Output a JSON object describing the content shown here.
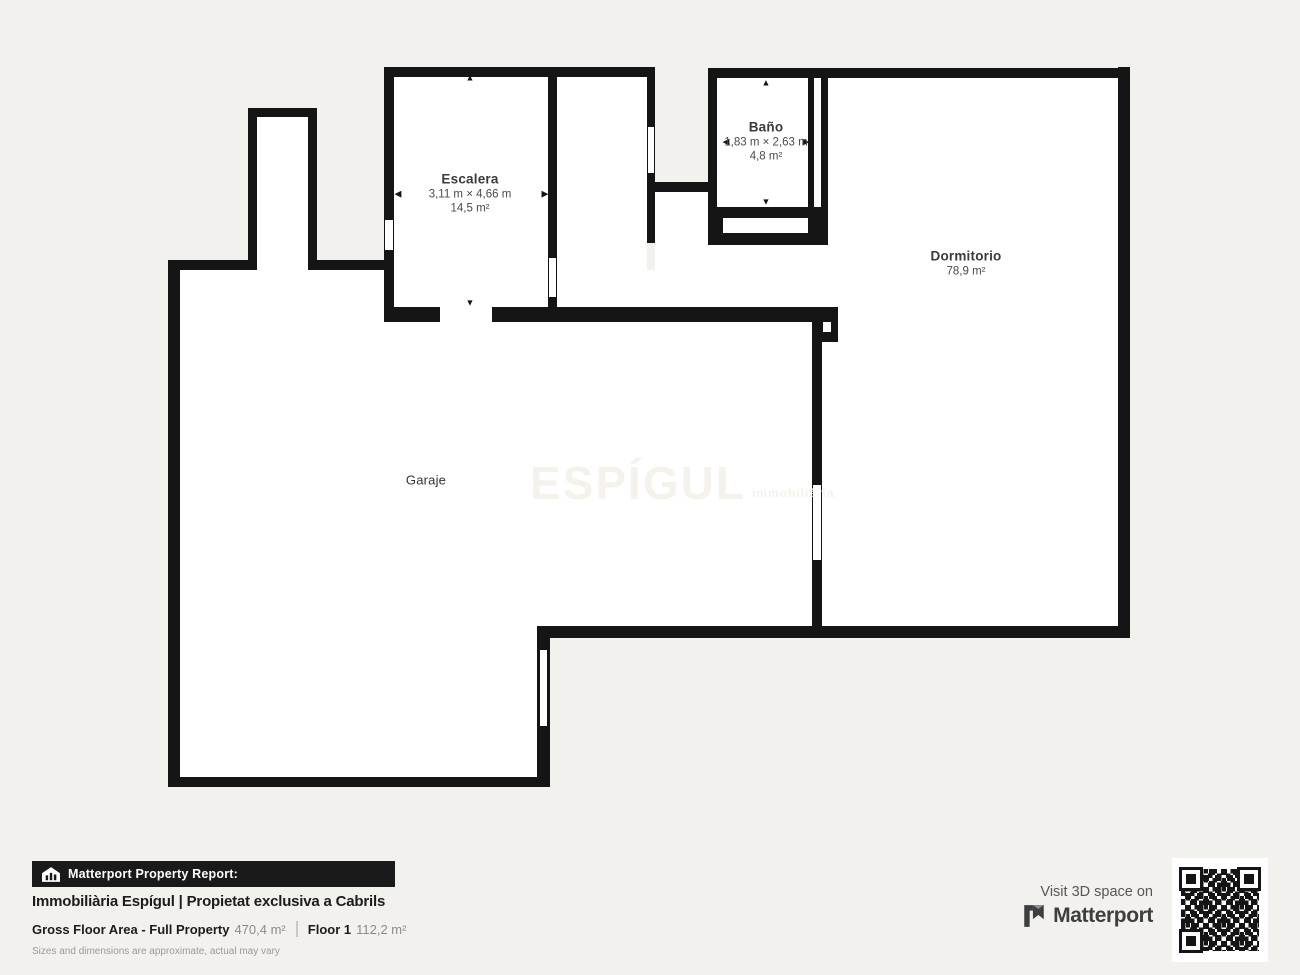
{
  "plan": {
    "rooms": {
      "escalera": {
        "name": "Escalera",
        "dims": "3,11 m × 4,66 m",
        "area": "14,5 m²"
      },
      "bano": {
        "name": "Baño",
        "dims": "1,83 m × 2,63 m",
        "area": "4,8 m²"
      },
      "dormitorio": {
        "name": "Dormitorio",
        "area": "78,9 m²"
      },
      "garaje": {
        "name": "Garaje"
      }
    },
    "icons": {
      "arrow_up": "▲",
      "arrow_down": "▼",
      "arrow_left": "◀",
      "arrow_right": "▶"
    },
    "watermark": {
      "main": "ESPÍGUL",
      "sub": "immobiliària"
    }
  },
  "footer": {
    "report_badge": "Matterport Property Report:",
    "title": "Immobiliària Espígul | Propietat exclusiva a Cabrils",
    "gfa_label": "Gross Floor Area - Full Property",
    "gfa_value": "470,4 m²",
    "floor_label": "Floor 1",
    "floor_value": "112,2 m²",
    "disclaimer": "Sizes and dimensions are approximate, actual may vary"
  },
  "cta": {
    "visit_text": "Visit 3D space on",
    "brand": "Matterport"
  },
  "colors": {
    "background": "#f2f1ee",
    "wall": "#151515",
    "floor": "#ffffff",
    "footer_bar": "#1a1a1a",
    "text_dark": "#1c1c1c",
    "text_gray": "#8b8b8b",
    "brand_gray": "#3e3e3e"
  }
}
